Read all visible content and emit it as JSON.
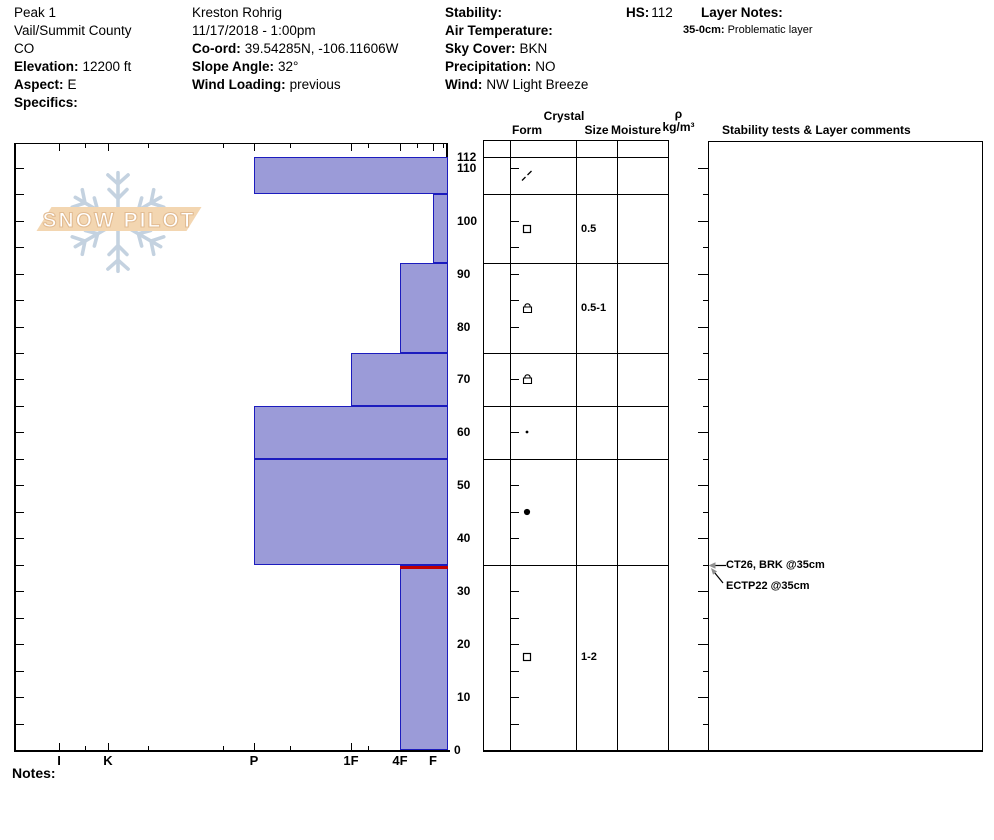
{
  "header": {
    "site": {
      "name": "Peak 1",
      "region": "Vail/Summit County",
      "state": "CO",
      "elevation_label": "Elevation:",
      "elevation_value": "12200 ft",
      "aspect_label": "Aspect:",
      "aspect_value": "E",
      "specifics_label": "Specifics:",
      "specifics_value": ""
    },
    "observation": {
      "observer": "Kreston Rohrig",
      "datetime": "11/17/2018 - 1:00pm",
      "coord_label": "Co-ord:",
      "coord_value": "39.54285N, -106.11606W",
      "slope_angle_label": "Slope Angle:",
      "slope_angle_value": "32°",
      "wind_loading_label": "Wind Loading:",
      "wind_loading_value": "previous"
    },
    "conditions": {
      "stability_label": "Stability:",
      "stability_value": "",
      "air_temperature_label": "Air Temperature:",
      "air_temperature_value": "",
      "sky_cover_label": "Sky Cover:",
      "sky_cover_value": "BKN",
      "precipitation_label": "Precipitation:",
      "precipitation_value": "NO",
      "wind_label": "Wind:",
      "wind_value": "NW Light Breeze"
    },
    "hs_label": "HS:",
    "hs_value": "112",
    "layer_notes_label": "Layer Notes:",
    "layer_note": {
      "range": "35-0cm:",
      "text": "Problematic layer"
    }
  },
  "watermark": {
    "text": "SNOW PILOT"
  },
  "chart_data": {
    "type": "bar",
    "title": "Snowpit hardness profile",
    "orientation": "horizontal layered snow profile, bars anchored at soft (F) right edge",
    "x_axis": {
      "label": "hand hardness",
      "categories": [
        "I",
        "K",
        "P",
        "1F",
        "4F",
        "F"
      ]
    },
    "y_axis": {
      "label": "depth (cm)",
      "min": 0,
      "max": 115,
      "tick_labels": [
        112,
        110,
        100,
        90,
        80,
        70,
        60,
        50,
        40,
        30,
        20,
        10,
        0
      ],
      "minor_tick_step_cm": 5
    },
    "layers": [
      {
        "top_cm": 112,
        "bottom_cm": 105,
        "hardness": "P",
        "grain_form": "DF",
        "grain_form_name": "decomposing fragments",
        "grain_size_mm": "",
        "moisture": "",
        "density": ""
      },
      {
        "top_cm": 105,
        "bottom_cm": 92,
        "hardness": "F",
        "grain_form": "FC",
        "grain_form_name": "faceted crystals",
        "grain_size_mm": "0.5",
        "moisture": "",
        "density": ""
      },
      {
        "top_cm": 92,
        "bottom_cm": 75,
        "hardness": "4F",
        "grain_form": "FCxr",
        "grain_form_name": "rounding faceted crystals",
        "grain_size_mm": "0.5-1",
        "moisture": "",
        "density": ""
      },
      {
        "top_cm": 75,
        "bottom_cm": 65,
        "hardness": "1F",
        "grain_form": "FCxr",
        "grain_form_name": "rounding faceted crystals",
        "grain_size_mm": "",
        "moisture": "",
        "density": ""
      },
      {
        "top_cm": 65,
        "bottom_cm": 55,
        "hardness": "P",
        "grain_form": "RGsm",
        "grain_form_name": "rounded grains (small)",
        "grain_size_mm": "",
        "moisture": "",
        "density": ""
      },
      {
        "top_cm": 55,
        "bottom_cm": 35,
        "hardness": "P",
        "grain_form": "RG",
        "grain_form_name": "rounded grains",
        "grain_size_mm": "",
        "moisture": "",
        "density": ""
      },
      {
        "top_cm": 35,
        "bottom_cm": 0,
        "hardness": "4F",
        "grain_form": "FC",
        "grain_form_name": "faceted crystals",
        "grain_size_mm": "1-2",
        "moisture": "",
        "density": "",
        "problem_layer_top": true
      }
    ],
    "colors": {
      "bar_fill": "#9b9bd8",
      "bar_border": "#1c1cbe",
      "problem_line": "#c00000",
      "axis": "#000000"
    },
    "grid": false,
    "legend_position": "none"
  },
  "table": {
    "headers": {
      "crystal": "Crystal",
      "form": "Form",
      "size": "Size",
      "moisture": "Moisture",
      "rho": "ρ",
      "rho_units": "kg/m³",
      "stability": "Stability tests & Layer comments"
    }
  },
  "stability_tests": [
    {
      "text": "CT26, BRK @35cm",
      "depth_cm": 35
    },
    {
      "text": "ECTP22 @35cm",
      "depth_cm": 35
    }
  ],
  "notes_label": "Notes:"
}
